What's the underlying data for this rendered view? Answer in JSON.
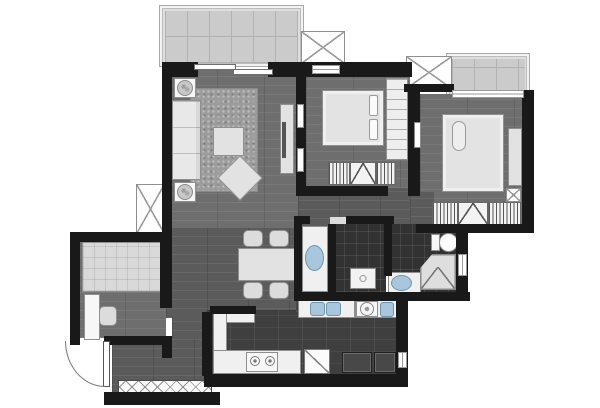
{
  "meta": {
    "title": "apartment-floor-plan",
    "canvas": {
      "w": 600,
      "h": 408
    }
  },
  "palette": {
    "wall": "#191919",
    "wood_floor": "#6e6e6e",
    "wood_floor_dark": "#5b5b5b",
    "kitchen_tile": "#3f3f3f",
    "bath_tile": "#323232",
    "balcony_tile": "#cbcbcb",
    "furniture_light": "#e2e2e2",
    "fixture_blue": "#a9c6dd",
    "background": "#ffffff"
  },
  "plan": {
    "elements": [
      {
        "name": "balcony-frame",
        "cls": "frame-light",
        "x": 159,
        "y": 5,
        "w": 145,
        "h": 62
      },
      {
        "name": "balcony-floor",
        "cls": "tile-light",
        "x": 165,
        "y": 11,
        "w": 133,
        "h": 52
      },
      {
        "name": "master-bay-frame",
        "cls": "frame-light",
        "x": 446,
        "y": 53,
        "w": 84,
        "h": 45
      },
      {
        "name": "master-bay-floor",
        "cls": "tile-light",
        "x": 452,
        "y": 59,
        "w": 73,
        "h": 35
      },
      {
        "name": "ac-platform-left",
        "cls": "x-box",
        "x": 136,
        "y": 184,
        "w": 29,
        "h": 50
      },
      {
        "name": "ac-platform-top",
        "cls": "x-box",
        "x": 301,
        "y": 31,
        "w": 44,
        "h": 33
      },
      {
        "name": "ac-platform-middle",
        "cls": "x-box",
        "x": 406,
        "y": 56,
        "w": 46,
        "h": 33
      },
      {
        "name": "living-room-floor",
        "cls": "wood",
        "x": 170,
        "y": 70,
        "w": 130,
        "h": 160
      },
      {
        "name": "dining-floor",
        "cls": "wood-dark",
        "x": 166,
        "y": 228,
        "w": 134,
        "h": 90
      },
      {
        "name": "passage-floor",
        "cls": "wood-dark",
        "x": 172,
        "y": 316,
        "w": 34,
        "h": 78
      },
      {
        "name": "entry-floor",
        "cls": "wood-dark",
        "x": 112,
        "y": 338,
        "w": 96,
        "h": 56
      },
      {
        "name": "study-floor",
        "cls": "wood",
        "x": 78,
        "y": 240,
        "w": 88,
        "h": 98
      },
      {
        "name": "corridor-floor",
        "cls": "wood-dark",
        "x": 298,
        "y": 186,
        "w": 170,
        "h": 42
      },
      {
        "name": "vanity-floor",
        "cls": "wood-dark",
        "x": 298,
        "y": 226,
        "w": 32,
        "h": 70
      },
      {
        "name": "bedroom1-floor",
        "cls": "wood",
        "x": 306,
        "y": 75,
        "w": 104,
        "h": 113
      },
      {
        "name": "master-bedroom-floor",
        "cls": "wood",
        "x": 420,
        "y": 94,
        "w": 104,
        "h": 132
      },
      {
        "name": "master-door-floor",
        "cls": "wood-dark",
        "x": 410,
        "y": 192,
        "w": 24,
        "h": 34
      },
      {
        "name": "kitchen-floor",
        "cls": "tile-dark",
        "x": 206,
        "y": 310,
        "w": 200,
        "h": 66
      },
      {
        "name": "laundry-floor",
        "cls": "tile-dark",
        "x": 352,
        "y": 298,
        "w": 52,
        "h": 16
      },
      {
        "name": "kitchen-sink-strip-floor",
        "cls": "tile-dark",
        "x": 296,
        "y": 299,
        "w": 56,
        "h": 13
      },
      {
        "name": "bathroom2-floor",
        "cls": "tile-bath",
        "x": 332,
        "y": 224,
        "w": 54,
        "h": 68
      },
      {
        "name": "master-bath-floor",
        "cls": "tile-bath",
        "x": 388,
        "y": 224,
        "w": 72,
        "h": 70
      },
      {
        "name": "living-rug",
        "cls": "rug",
        "x": 190,
        "y": 88,
        "w": 68,
        "h": 104
      },
      {
        "name": "sofa",
        "cls": "sofa",
        "x": 172,
        "y": 100,
        "w": 29,
        "h": 80
      },
      {
        "name": "side-table-top",
        "cls": "furn-white",
        "x": 174,
        "y": 78,
        "w": 22,
        "h": 20
      },
      {
        "name": "plant-top",
        "cls": "plant",
        "x": 177,
        "y": 80,
        "w": 16,
        "h": 16
      },
      {
        "name": "side-table-bottom",
        "cls": "furn-white",
        "x": 174,
        "y": 182,
        "w": 22,
        "h": 20
      },
      {
        "name": "plant-bottom",
        "cls": "plant",
        "x": 177,
        "y": 184,
        "w": 16,
        "h": 16
      },
      {
        "name": "coffee-table",
        "cls": "furn",
        "x": 213,
        "y": 127,
        "w": 31,
        "h": 29
      },
      {
        "name": "ottoman",
        "cls": "furn",
        "x": 224,
        "y": 162,
        "w": 32,
        "h": 32,
        "rot": 45
      },
      {
        "name": "tv-console",
        "cls": "furn",
        "x": 280,
        "y": 104,
        "w": 14,
        "h": 70
      },
      {
        "name": "tv",
        "cls": "dark-line",
        "x": 282,
        "y": 122,
        "w": 4,
        "h": 36
      },
      {
        "name": "bedroom1-bed",
        "cls": "bed",
        "x": 322,
        "y": 90,
        "w": 62,
        "h": 56
      },
      {
        "name": "bedroom1-pillow-1",
        "cls": "pillow",
        "x": 369,
        "y": 95,
        "w": 9,
        "h": 21
      },
      {
        "name": "bedroom1-pillow-2",
        "cls": "pillow",
        "x": 369,
        "y": 119,
        "w": 9,
        "h": 21
      },
      {
        "name": "bedroom1-wardrobe",
        "cls": "shelf",
        "x": 386,
        "y": 78,
        "w": 22,
        "h": 82
      },
      {
        "name": "bedroom1-closet-left",
        "cls": "hatch",
        "x": 328,
        "y": 162,
        "w": 22,
        "h": 23
      },
      {
        "name": "bedroom1-closet-mid",
        "cls": "v-box",
        "x": 350,
        "y": 162,
        "w": 26,
        "h": 23
      },
      {
        "name": "bedroom1-closet-right",
        "cls": "hatch",
        "x": 376,
        "y": 162,
        "w": 20,
        "h": 23
      },
      {
        "name": "master-bed",
        "cls": "bed",
        "x": 442,
        "y": 114,
        "w": 62,
        "h": 78
      },
      {
        "name": "master-pillow",
        "cls": "pillow-r",
        "x": 452,
        "y": 121,
        "w": 14,
        "h": 30
      },
      {
        "name": "master-dresser",
        "cls": "furn",
        "x": 508,
        "y": 128,
        "w": 14,
        "h": 58
      },
      {
        "name": "master-nightstand",
        "cls": "x-box",
        "x": 506,
        "y": 188,
        "w": 15,
        "h": 14
      },
      {
        "name": "master-closet-left",
        "cls": "hatch",
        "x": 432,
        "y": 202,
        "w": 26,
        "h": 23
      },
      {
        "name": "master-closet-mid",
        "cls": "v-box",
        "x": 458,
        "y": 202,
        "w": 30,
        "h": 23
      },
      {
        "name": "master-closet-right",
        "cls": "hatch",
        "x": 488,
        "y": 202,
        "w": 33,
        "h": 23
      },
      {
        "name": "study-bed",
        "cls": "bed-grid",
        "x": 82,
        "y": 242,
        "w": 79,
        "h": 50
      },
      {
        "name": "study-desk",
        "cls": "furn-white",
        "x": 84,
        "y": 294,
        "w": 16,
        "h": 46
      },
      {
        "name": "study-chair",
        "cls": "chair",
        "x": 99,
        "y": 306,
        "w": 18,
        "h": 20
      },
      {
        "name": "dining-table",
        "cls": "furn",
        "x": 238,
        "y": 248,
        "w": 58,
        "h": 33
      },
      {
        "name": "dining-chair-1",
        "cls": "chair",
        "x": 243,
        "y": 230,
        "w": 20,
        "h": 17
      },
      {
        "name": "dining-chair-2",
        "cls": "chair",
        "x": 269,
        "y": 230,
        "w": 20,
        "h": 17
      },
      {
        "name": "dining-chair-3",
        "cls": "chair",
        "x": 243,
        "y": 282,
        "w": 20,
        "h": 17
      },
      {
        "name": "dining-chair-4",
        "cls": "chair",
        "x": 269,
        "y": 282,
        "w": 20,
        "h": 17
      },
      {
        "name": "vanity-counter",
        "cls": "counter",
        "x": 302,
        "y": 226,
        "w": 26,
        "h": 66
      },
      {
        "name": "vanity-basin",
        "cls": "basin-oval",
        "x": 305,
        "y": 245,
        "w": 19,
        "h": 26
      },
      {
        "name": "bathroom2-shower-tray",
        "cls": "tray",
        "x": 350,
        "y": 268,
        "w": 26,
        "h": 21
      },
      {
        "name": "toilet-tank",
        "cls": "furn-white",
        "x": 431,
        "y": 234,
        "w": 9,
        "h": 17
      },
      {
        "name": "toilet-bowl",
        "cls": "oval-white",
        "x": 439,
        "y": 233,
        "w": 19,
        "h": 19
      },
      {
        "name": "master-bath-counter",
        "cls": "counter",
        "x": 388,
        "y": 272,
        "w": 33,
        "h": 22
      },
      {
        "name": "master-bath-basin",
        "cls": "basin-oval",
        "x": 391,
        "y": 275,
        "w": 21,
        "h": 16
      },
      {
        "name": "master-shower",
        "cls": "shower",
        "x": 420,
        "y": 254,
        "w": 36,
        "h": 36
      },
      {
        "name": "kitchen-counter-back",
        "cls": "counter",
        "x": 213,
        "y": 310,
        "w": 42,
        "h": 13
      },
      {
        "name": "kitchen-counter-left",
        "cls": "counter",
        "x": 213,
        "y": 310,
        "w": 14,
        "h": 64
      },
      {
        "name": "kitchen-counter-bottom",
        "cls": "counter",
        "x": 213,
        "y": 350,
        "w": 88,
        "h": 24
      },
      {
        "name": "stove",
        "cls": "furn-white",
        "x": 246,
        "y": 352,
        "w": 32,
        "h": 20
      },
      {
        "name": "burner-left",
        "cls": "burner",
        "x": 250,
        "y": 356,
        "w": 10,
        "h": 10
      },
      {
        "name": "burner-right",
        "cls": "burner",
        "x": 265,
        "y": 356,
        "w": 10,
        "h": 10
      },
      {
        "name": "washing-machine",
        "cls": "slash-box",
        "x": 304,
        "y": 349,
        "w": 26,
        "h": 25
      },
      {
        "name": "kitchen-sink-counter",
        "cls": "counter",
        "x": 298,
        "y": 300,
        "w": 57,
        "h": 18
      },
      {
        "name": "kitchen-sink-left",
        "cls": "basin-rect",
        "x": 310,
        "y": 302,
        "w": 15,
        "h": 14
      },
      {
        "name": "kitchen-sink-right",
        "cls": "basin-rect",
        "x": 326,
        "y": 302,
        "w": 15,
        "h": 14
      },
      {
        "name": "laundry-counter",
        "cls": "counter",
        "x": 355,
        "y": 300,
        "w": 43,
        "h": 18
      },
      {
        "name": "laundry-washer",
        "cls": "furn-white",
        "x": 356,
        "y": 301,
        "w": 22,
        "h": 16
      },
      {
        "name": "laundry-washer-door",
        "cls": "ring",
        "x": 360,
        "y": 302,
        "w": 14,
        "h": 14
      },
      {
        "name": "laundry-sink",
        "cls": "basin-rect",
        "x": 380,
        "y": 302,
        "w": 14,
        "h": 15
      },
      {
        "name": "laundry-cabinet-1",
        "cls": "cab-dark",
        "x": 342,
        "y": 352,
        "w": 30,
        "h": 21
      },
      {
        "name": "laundry-cabinet-2",
        "cls": "cab-dark",
        "x": 374,
        "y": 352,
        "w": 22,
        "h": 21
      },
      {
        "name": "shoe-cabinet",
        "cls": "xstrip",
        "x": 118,
        "y": 380,
        "w": 94,
        "h": 14
      },
      {
        "name": "wall-top-left",
        "cls": "wall",
        "x": 162,
        "y": 62,
        "w": 36,
        "h": 15
      },
      {
        "name": "wall-top-right",
        "cls": "wall",
        "x": 268,
        "y": 62,
        "w": 46,
        "h": 15
      },
      {
        "name": "wall-west-upper",
        "cls": "wall",
        "x": 162,
        "y": 62,
        "w": 10,
        "h": 126
      },
      {
        "name": "wall-west-lower",
        "cls": "wall",
        "x": 162,
        "y": 186,
        "w": 10,
        "h": 50
      },
      {
        "name": "wall-study-top",
        "cls": "wall",
        "x": 70,
        "y": 232,
        "w": 102,
        "h": 10
      },
      {
        "name": "wall-study-west",
        "cls": "wall",
        "x": 70,
        "y": 232,
        "w": 10,
        "h": 112
      },
      {
        "name": "wall-study-east-upper",
        "cls": "wall",
        "x": 160,
        "y": 242,
        "w": 12,
        "h": 66
      },
      {
        "name": "wall-study-east-lower",
        "cls": "wall",
        "x": 162,
        "y": 338,
        "w": 10,
        "h": 20
      },
      {
        "name": "wall-study-bottom-left",
        "cls": "wall",
        "x": 70,
        "y": 336,
        "w": 10,
        "h": 9
      },
      {
        "name": "wall-study-bottom-right",
        "cls": "wall",
        "x": 104,
        "y": 336,
        "w": 68,
        "h": 9
      },
      {
        "name": "wall-entry-bottom",
        "cls": "wall",
        "x": 104,
        "y": 392,
        "w": 116,
        "h": 13
      },
      {
        "name": "wall-kitchen-west",
        "cls": "wall",
        "x": 202,
        "y": 312,
        "w": 10,
        "h": 64
      },
      {
        "name": "wall-kitchen-back",
        "cls": "wall",
        "x": 210,
        "y": 306,
        "w": 46,
        "h": 8
      },
      {
        "name": "wall-bottom",
        "cls": "wall",
        "x": 204,
        "y": 374,
        "w": 204,
        "h": 13
      },
      {
        "name": "wall-laundry-east",
        "cls": "wall",
        "x": 396,
        "y": 292,
        "w": 12,
        "h": 84
      },
      {
        "name": "wall-bath-south",
        "cls": "wall",
        "x": 294,
        "y": 292,
        "w": 176,
        "h": 9
      },
      {
        "name": "wall-masterbath-east",
        "cls": "wall",
        "x": 456,
        "y": 224,
        "w": 12,
        "h": 70
      },
      {
        "name": "wall-master-south",
        "cls": "wall",
        "x": 416,
        "y": 224,
        "w": 112,
        "h": 9
      },
      {
        "name": "wall-bath-divider",
        "cls": "wall",
        "x": 384,
        "y": 224,
        "w": 8,
        "h": 52
      },
      {
        "name": "wall-bath2-west",
        "cls": "wall",
        "x": 328,
        "y": 224,
        "w": 8,
        "h": 68
      },
      {
        "name": "wall-vanity-west",
        "cls": "wall",
        "x": 294,
        "y": 222,
        "w": 8,
        "h": 72
      },
      {
        "name": "wall-corridor-south-1",
        "cls": "wall",
        "x": 294,
        "y": 216,
        "w": 16,
        "h": 8
      },
      {
        "name": "wall-corridor-south-2",
        "cls": "wall",
        "x": 346,
        "y": 216,
        "w": 48,
        "h": 8
      },
      {
        "name": "wall-bedroom1-west",
        "cls": "wall",
        "x": 296,
        "y": 70,
        "w": 10,
        "h": 126
      },
      {
        "name": "wall-bedroom1-north",
        "cls": "wall",
        "x": 296,
        "y": 62,
        "w": 116,
        "h": 15
      },
      {
        "name": "wall-bedroom1-south",
        "cls": "wall",
        "x": 296,
        "y": 186,
        "w": 92,
        "h": 10
      },
      {
        "name": "wall-bedroom1-south-stub",
        "cls": "wall",
        "x": 408,
        "y": 186,
        "w": 12,
        "h": 10
      },
      {
        "name": "wall-bedroom1-east",
        "cls": "wall",
        "x": 408,
        "y": 86,
        "w": 12,
        "h": 110
      },
      {
        "name": "wall-master-north-west",
        "cls": "wall",
        "x": 404,
        "y": 84,
        "w": 50,
        "h": 8
      },
      {
        "name": "wall-master-east",
        "cls": "wall",
        "x": 522,
        "y": 90,
        "w": 12,
        "h": 143
      },
      {
        "name": "window-bedroom1",
        "cls": "win",
        "x": 312,
        "y": 65,
        "w": 28,
        "h": 9
      },
      {
        "name": "window-master-bay",
        "cls": "win",
        "x": 452,
        "y": 90,
        "w": 72,
        "h": 8
      },
      {
        "name": "window-master-bath",
        "cls": "win-v",
        "x": 458,
        "y": 254,
        "w": 9,
        "h": 22
      },
      {
        "name": "window-laundry",
        "cls": "win-v",
        "x": 398,
        "y": 352,
        "w": 9,
        "h": 16
      },
      {
        "name": "curtain-mark-1",
        "cls": "wm",
        "x": 297,
        "y": 104,
        "w": 7,
        "h": 24
      },
      {
        "name": "curtain-mark-2",
        "cls": "wm",
        "x": 297,
        "y": 148,
        "w": 7,
        "h": 24
      },
      {
        "name": "curtain-mark-3",
        "cls": "wm",
        "x": 414,
        "y": 122,
        "w": 7,
        "h": 26
      },
      {
        "name": "sliding-door-panel-1",
        "cls": "sd",
        "x": 194,
        "y": 64,
        "w": 42,
        "h": 6
      },
      {
        "name": "sliding-door-panel-2",
        "cls": "sd",
        "x": 233,
        "y": 69,
        "w": 40,
        "h": 6
      },
      {
        "name": "bathroom2-door-gap",
        "cls": "gap",
        "x": 330,
        "y": 217,
        "w": 16,
        "h": 7
      },
      {
        "name": "entry-door-leaf",
        "cls": "leaf",
        "x": 103,
        "y": 341,
        "w": 7,
        "h": 46
      },
      {
        "name": "entry-door-arc",
        "cls": "arc",
        "x": 65,
        "y": 341,
        "w": 40,
        "h": 46
      }
    ]
  }
}
